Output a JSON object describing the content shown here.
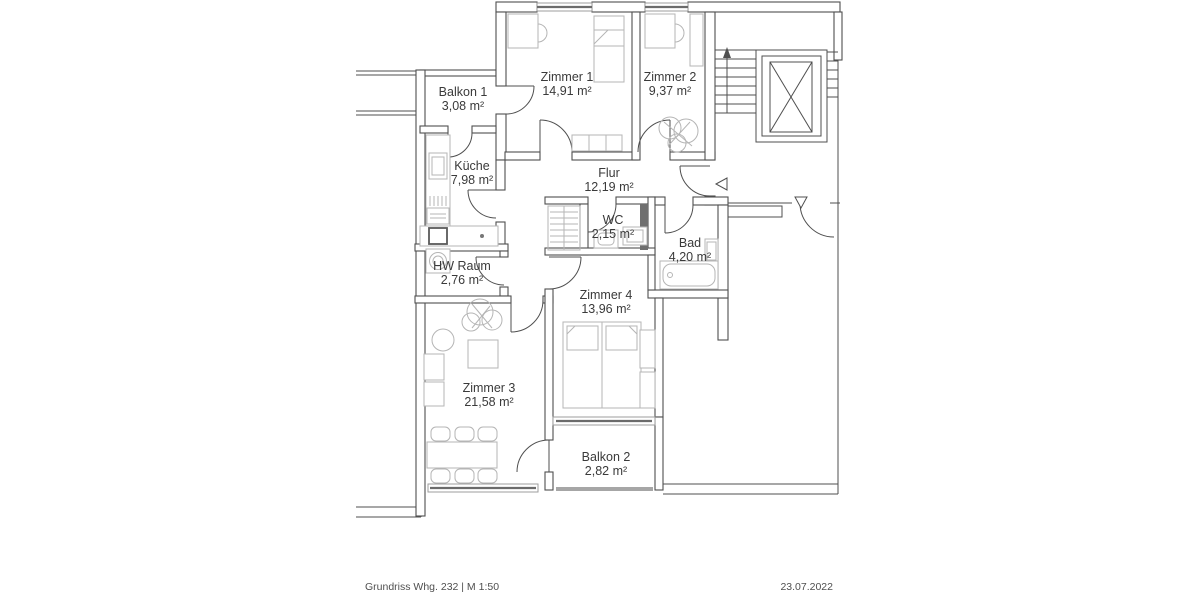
{
  "document": {
    "type_label": "floor-plan",
    "footer_left": "Grundriss Whg. 232 | M 1:50",
    "footer_right": "23.07.2022"
  },
  "rooms": [
    {
      "id": "balkon-1",
      "name": "Balkon 1",
      "area": "3,08 m²"
    },
    {
      "id": "zimmer-1",
      "name": "Zimmer 1",
      "area": "14,91 m²"
    },
    {
      "id": "zimmer-2",
      "name": "Zimmer 2",
      "area": "9,37 m²"
    },
    {
      "id": "kueche",
      "name": "Küche",
      "area": "7,98 m²"
    },
    {
      "id": "flur",
      "name": "Flur",
      "area": "12,19 m²"
    },
    {
      "id": "wc",
      "name": "WC",
      "area": "2,15 m²"
    },
    {
      "id": "bad",
      "name": "Bad",
      "area": "4,20 m²"
    },
    {
      "id": "hw-raum",
      "name": "HW Raum",
      "area": "2,76 m²"
    },
    {
      "id": "zimmer-4",
      "name": "Zimmer 4",
      "area": "13,96 m²"
    },
    {
      "id": "zimmer-3",
      "name": "Zimmer 3",
      "area": "21,58 m²"
    },
    {
      "id": "balkon-2",
      "name": "Balkon 2",
      "area": "2,82 m²"
    }
  ],
  "icons": {
    "entry_marker": "left-triangle-icon",
    "neighbor_entry_marker": "down-triangle-icon",
    "stair_direction": "up-arrow-icon"
  },
  "colors": {
    "wall_line": "#4f4f4f",
    "furniture_line": "#b5b5b5",
    "window_line": "#9e9e9e",
    "railing": "#a6a6a6",
    "shaft_fill": "#6f6f6f",
    "label_text": "#3a3a3a",
    "footer_text": "#4f4f4f",
    "background": "#ffffff"
  }
}
